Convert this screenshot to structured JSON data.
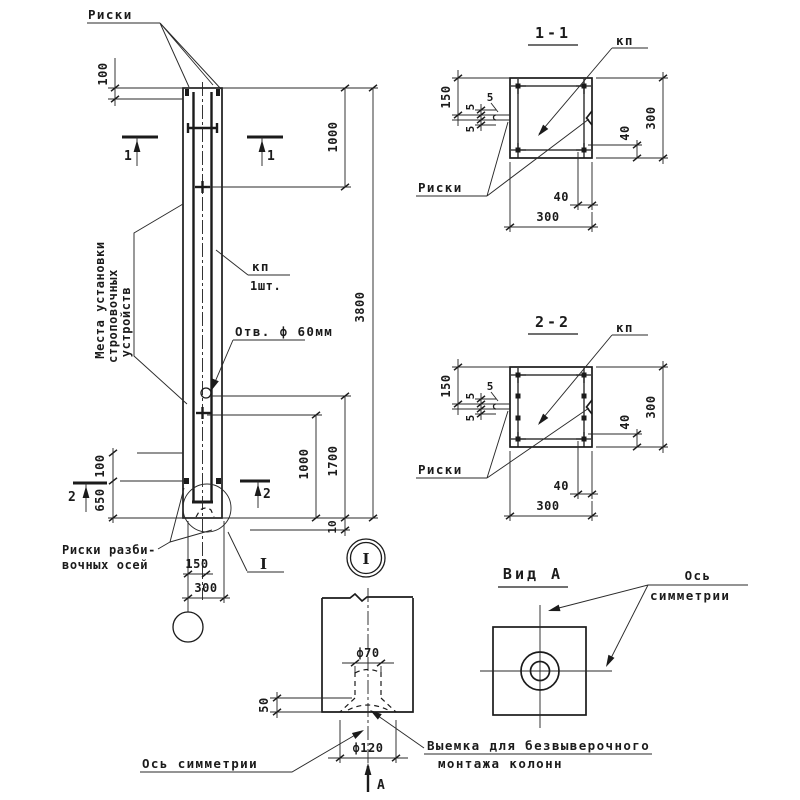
{
  "meta": {
    "ink": "#1b1b1b",
    "background": "#ffffff"
  },
  "elevation": {
    "riski_top": "Риски",
    "mesta1": "Места установки",
    "mesta2": "строповочных",
    "mesta3": "устройств",
    "kp": "кп",
    "kp_qty": "1шт.",
    "hole_label": "Отв. ф 60мм",
    "riski_axes1": "Риски разби-",
    "riski_axes2": "вочных осей",
    "detail_ref": "I",
    "cut1": "1",
    "cut2": "2",
    "dim_top": "100",
    "dim_top_lift": "1000",
    "dim_total": "3800",
    "dim_hole": "1700",
    "dim_bot_lift": "1000",
    "dim_axes": "650",
    "dim_axes_gap": "100",
    "dim_bot": "10",
    "dim_half": "150",
    "dim_width": "300"
  },
  "section1": {
    "title": "1-1",
    "kp": "кп",
    "riski": "Риски",
    "dim_150": "150",
    "dim_5a": "5",
    "dim_5b": "5",
    "dim_5c": "5",
    "dim_300r": "300",
    "dim_40r": "40",
    "dim_40b": "40",
    "dim_300b": "300"
  },
  "section2": {
    "title": "2-2",
    "kp": "кп",
    "riski": "Риски",
    "dim_150": "150",
    "dim_5a": "5",
    "dim_5b": "5",
    "dim_5c": "5",
    "dim_300r": "300",
    "dim_40r": "40",
    "dim_40b": "40",
    "dim_300b": "300"
  },
  "detail": {
    "marker": "I",
    "dim_d70": "ф70",
    "dim_d120": "ф120",
    "dim_depth": "50",
    "axis_label": "Ось симметрии",
    "recess1": "Выемка для безвыверочного",
    "recess2": "монтажа  колонн",
    "view_dir": "А"
  },
  "viewA": {
    "title": "Вид А",
    "axis1": "Ось",
    "axis2": "симметрии"
  }
}
